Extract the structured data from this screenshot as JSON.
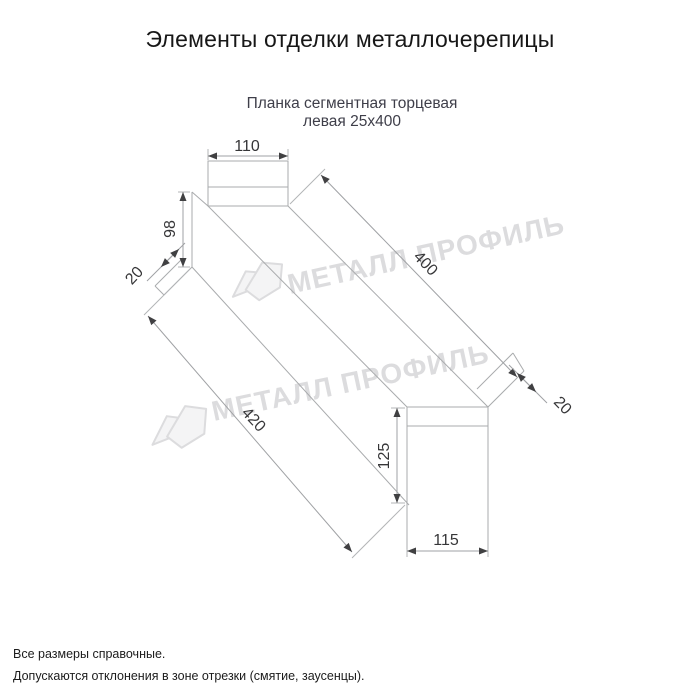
{
  "header": {
    "title": "Элементы отделки металлочерепицы",
    "subtitle_line1": "Планка сегментная торцевая",
    "subtitle_line2": "левая 25х400"
  },
  "drawing": {
    "part_name": "Планка сегментная торцевая левая 25х400",
    "dims": {
      "top_width": "110",
      "left_height": "98",
      "left_hem": "20",
      "length_top": "400",
      "length_bottom": "420",
      "right_hem": "20",
      "end_height": "125",
      "end_width": "115"
    },
    "colors": {
      "line": "#a9abad",
      "dim_text": "#363638",
      "arrow": "#404042"
    }
  },
  "watermark": {
    "text": "МЕТАЛЛ ПРОФИЛЬ",
    "color": "#dcdcde"
  },
  "footer": {
    "line1": "Все размеры справочные.",
    "line2": "Допускаются отклонения в зоне отрезки (смятие, заусенцы)."
  }
}
